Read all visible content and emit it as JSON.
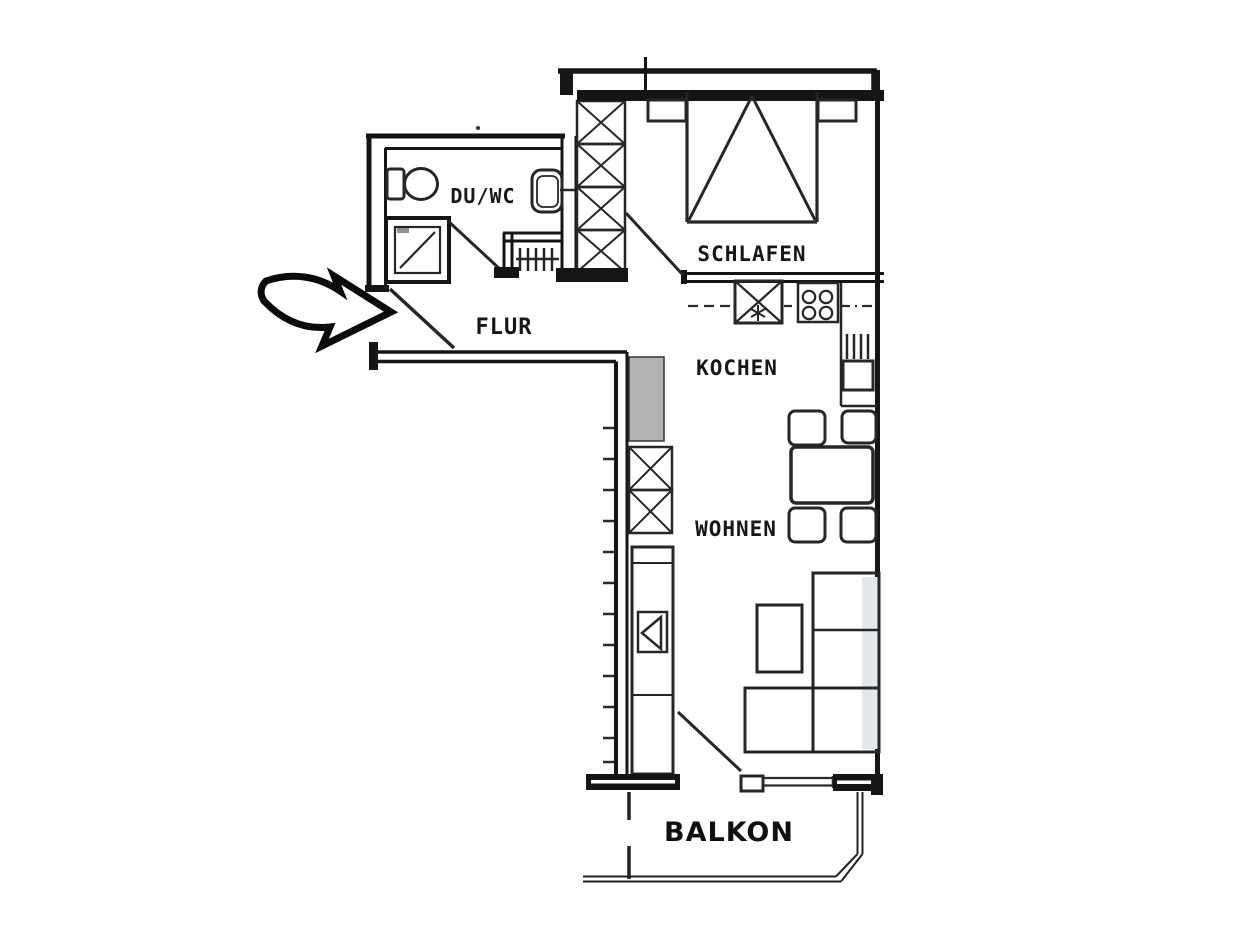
{
  "title": "Apartment floor plan with entrance arrow",
  "rooms": {
    "bathroom": {
      "label": "DU/WC"
    },
    "hallway": {
      "label": "FLUR"
    },
    "bedroom": {
      "label": "SCHLAFEN"
    },
    "kitchen": {
      "label": "KOCHEN"
    },
    "living": {
      "label": "WOHNEN"
    },
    "balcony": {
      "label": "BALKON"
    }
  },
  "icons": {
    "entrance_arrow": "entrance-arrow-icon",
    "bathroom": [
      "toilet",
      "washbasin",
      "shower",
      "radiator"
    ],
    "bedroom": [
      "double-bed",
      "nightstand-left",
      "nightstand-right",
      "wardrobe-crosshatch"
    ],
    "kitchen": [
      "kitchen-sink",
      "stove-4-burners",
      "refrigerator",
      "counter"
    ],
    "living": [
      "dining-table",
      "dining-chairs",
      "corner-sofa",
      "coffee-table",
      "tv-sideboard",
      "closet-crosshatch"
    ],
    "doors": [
      "entrance-door",
      "bathroom-door",
      "bedroom-door",
      "balcony-door"
    ]
  },
  "colors": {
    "wall": "#151515",
    "furniture_line": "#262626",
    "light_fill": "#e9edef",
    "gray_fill": "#b3b3b3",
    "sofa_shade": "#e3e8ea",
    "background": "#ffffff"
  }
}
